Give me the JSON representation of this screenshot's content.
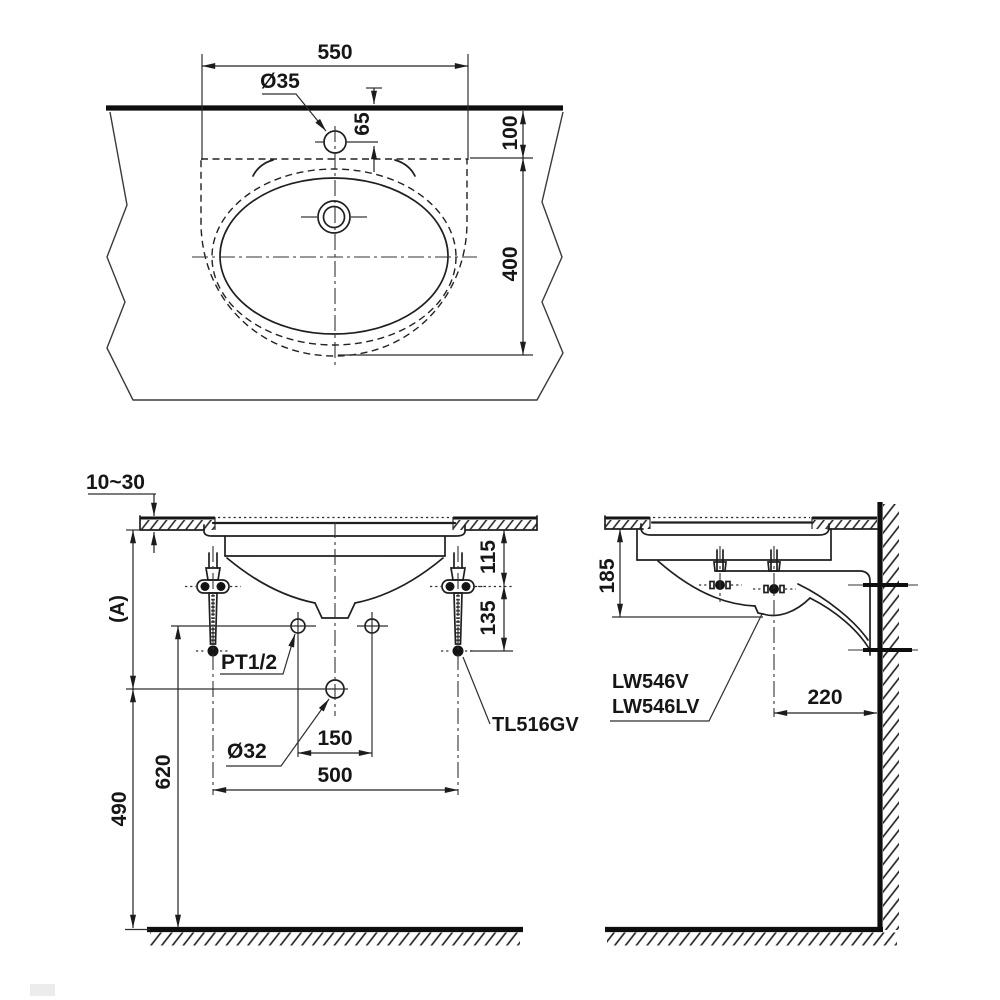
{
  "drawing": {
    "top_view": {
      "width": "550",
      "faucet_hole_dia": "Ø35",
      "faucet_offset": "65",
      "front_gap": "100",
      "cutout_depth": "400"
    },
    "front_view": {
      "counter_thickness": "10~30",
      "counter_height_ref": "(A)",
      "supply_thread": "PT1/2",
      "drain_dia": "Ø32",
      "supply_spacing": "150",
      "shank_spacing": "500",
      "supply_height": "620",
      "drain_height": "490",
      "rim_to_supply": "115",
      "supply_to_valve_end": "135",
      "valve_model": "TL516GV"
    },
    "side_view": {
      "bowl_depth": "185",
      "wall_offset": "220",
      "model_line1": "LW546V",
      "model_line2": "LW546LV"
    },
    "colors": {
      "ink": "#1a1a1a",
      "paper": "#ffffff"
    }
  }
}
